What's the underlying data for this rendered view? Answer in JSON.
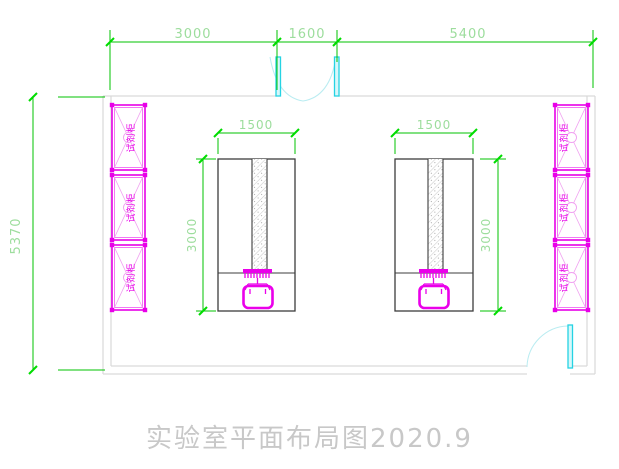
{
  "drawing": {
    "title": "实验室平面布局图2020.9"
  },
  "dimensions": {
    "top_segment_1": "3000",
    "top_segment_2": "1600",
    "top_segment_3": "5400",
    "room_height": "5370",
    "bench_width": "1500",
    "bench_length": "3000"
  },
  "cabinet": {
    "label": "试剂柜",
    "count_left": 3,
    "count_right": 3
  },
  "colors": {
    "dimension_line_green": "#00c300",
    "dimension_text_green": "#9ddd9d",
    "cabinet_magenta": "#e800e8",
    "door_cyan": "#25d3e3",
    "door_arc_cyan": "#b9ecf1",
    "wall_gray": "#d9d9d9",
    "bench_outline": "#3c3c3c",
    "title_gray": "#c8c8c8"
  }
}
